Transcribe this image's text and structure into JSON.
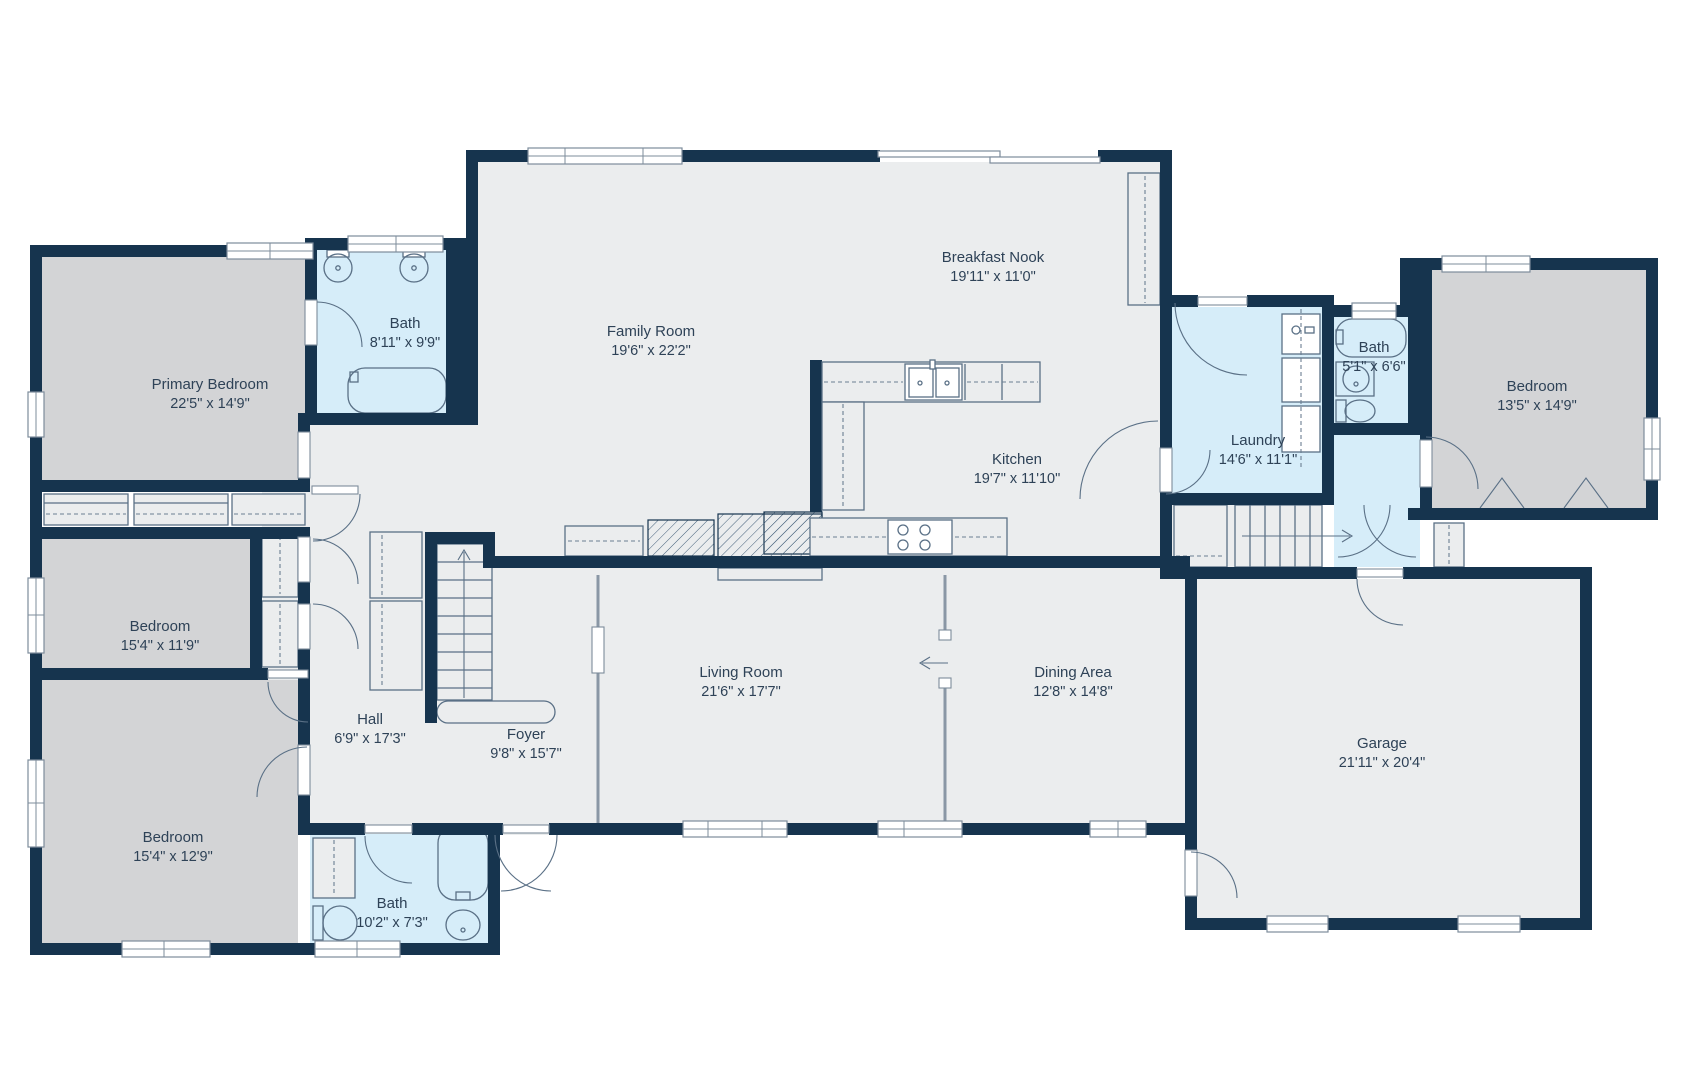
{
  "plan": {
    "colors": {
      "wall": "#16344e",
      "common_floor": "#ebedee",
      "bedroom_floor": "#d3d4d6",
      "bath_floor": "#d6edf9",
      "label_text": "#2e4257",
      "fixture_line": "#5a7086",
      "background": "#ffffff"
    },
    "rooms": [
      {
        "id": "primary-bedroom",
        "name": "Primary Bedroom",
        "dims": "22'5\" x 14'9\"",
        "x": 210,
        "y": 389
      },
      {
        "id": "bath-primary",
        "name": "Bath",
        "dims": "8'11\" x 9'9\"",
        "x": 405,
        "y": 328
      },
      {
        "id": "family-room",
        "name": "Family Room",
        "dims": "19'6\" x 22'2\"",
        "x": 651,
        "y": 336
      },
      {
        "id": "breakfast-nook",
        "name": "Breakfast Nook",
        "dims": "19'11\" x 11'0\"",
        "x": 993,
        "y": 262
      },
      {
        "id": "kitchen",
        "name": "Kitchen",
        "dims": "19'7\" x 11'10\"",
        "x": 1017,
        "y": 464
      },
      {
        "id": "laundry",
        "name": "Laundry",
        "dims": "14'6\" x 11'1\"",
        "x": 1258,
        "y": 445
      },
      {
        "id": "bath-hall-upper",
        "name": "Bath",
        "dims": "5'1\" x 6'6\"",
        "x": 1374,
        "y": 352
      },
      {
        "id": "bedroom-right",
        "name": "Bedroom",
        "dims": "13'5\" x 14'9\"",
        "x": 1537,
        "y": 391
      },
      {
        "id": "bedroom-mid-left",
        "name": "Bedroom",
        "dims": "15'4\" x 11'9\"",
        "x": 160,
        "y": 631
      },
      {
        "id": "hall",
        "name": "Hall",
        "dims": "6'9\" x 17'3\"",
        "x": 370,
        "y": 724
      },
      {
        "id": "foyer",
        "name": "Foyer",
        "dims": "9'8\" x 15'7\"",
        "x": 526,
        "y": 739
      },
      {
        "id": "living-room",
        "name": "Living Room",
        "dims": "21'6\" x 17'7\"",
        "x": 741,
        "y": 677
      },
      {
        "id": "dining-area",
        "name": "Dining Area",
        "dims": "12'8\" x 14'8\"",
        "x": 1073,
        "y": 677
      },
      {
        "id": "garage",
        "name": "Garage",
        "dims": "21'11\" x 20'4\"",
        "x": 1382,
        "y": 748
      },
      {
        "id": "bedroom-bottom-left",
        "name": "Bedroom",
        "dims": "15'4\" x 12'9\"",
        "x": 173,
        "y": 842
      },
      {
        "id": "bath-lower",
        "name": "Bath",
        "dims": "10'2\" x 7'3\"",
        "x": 392,
        "y": 908
      }
    ]
  }
}
